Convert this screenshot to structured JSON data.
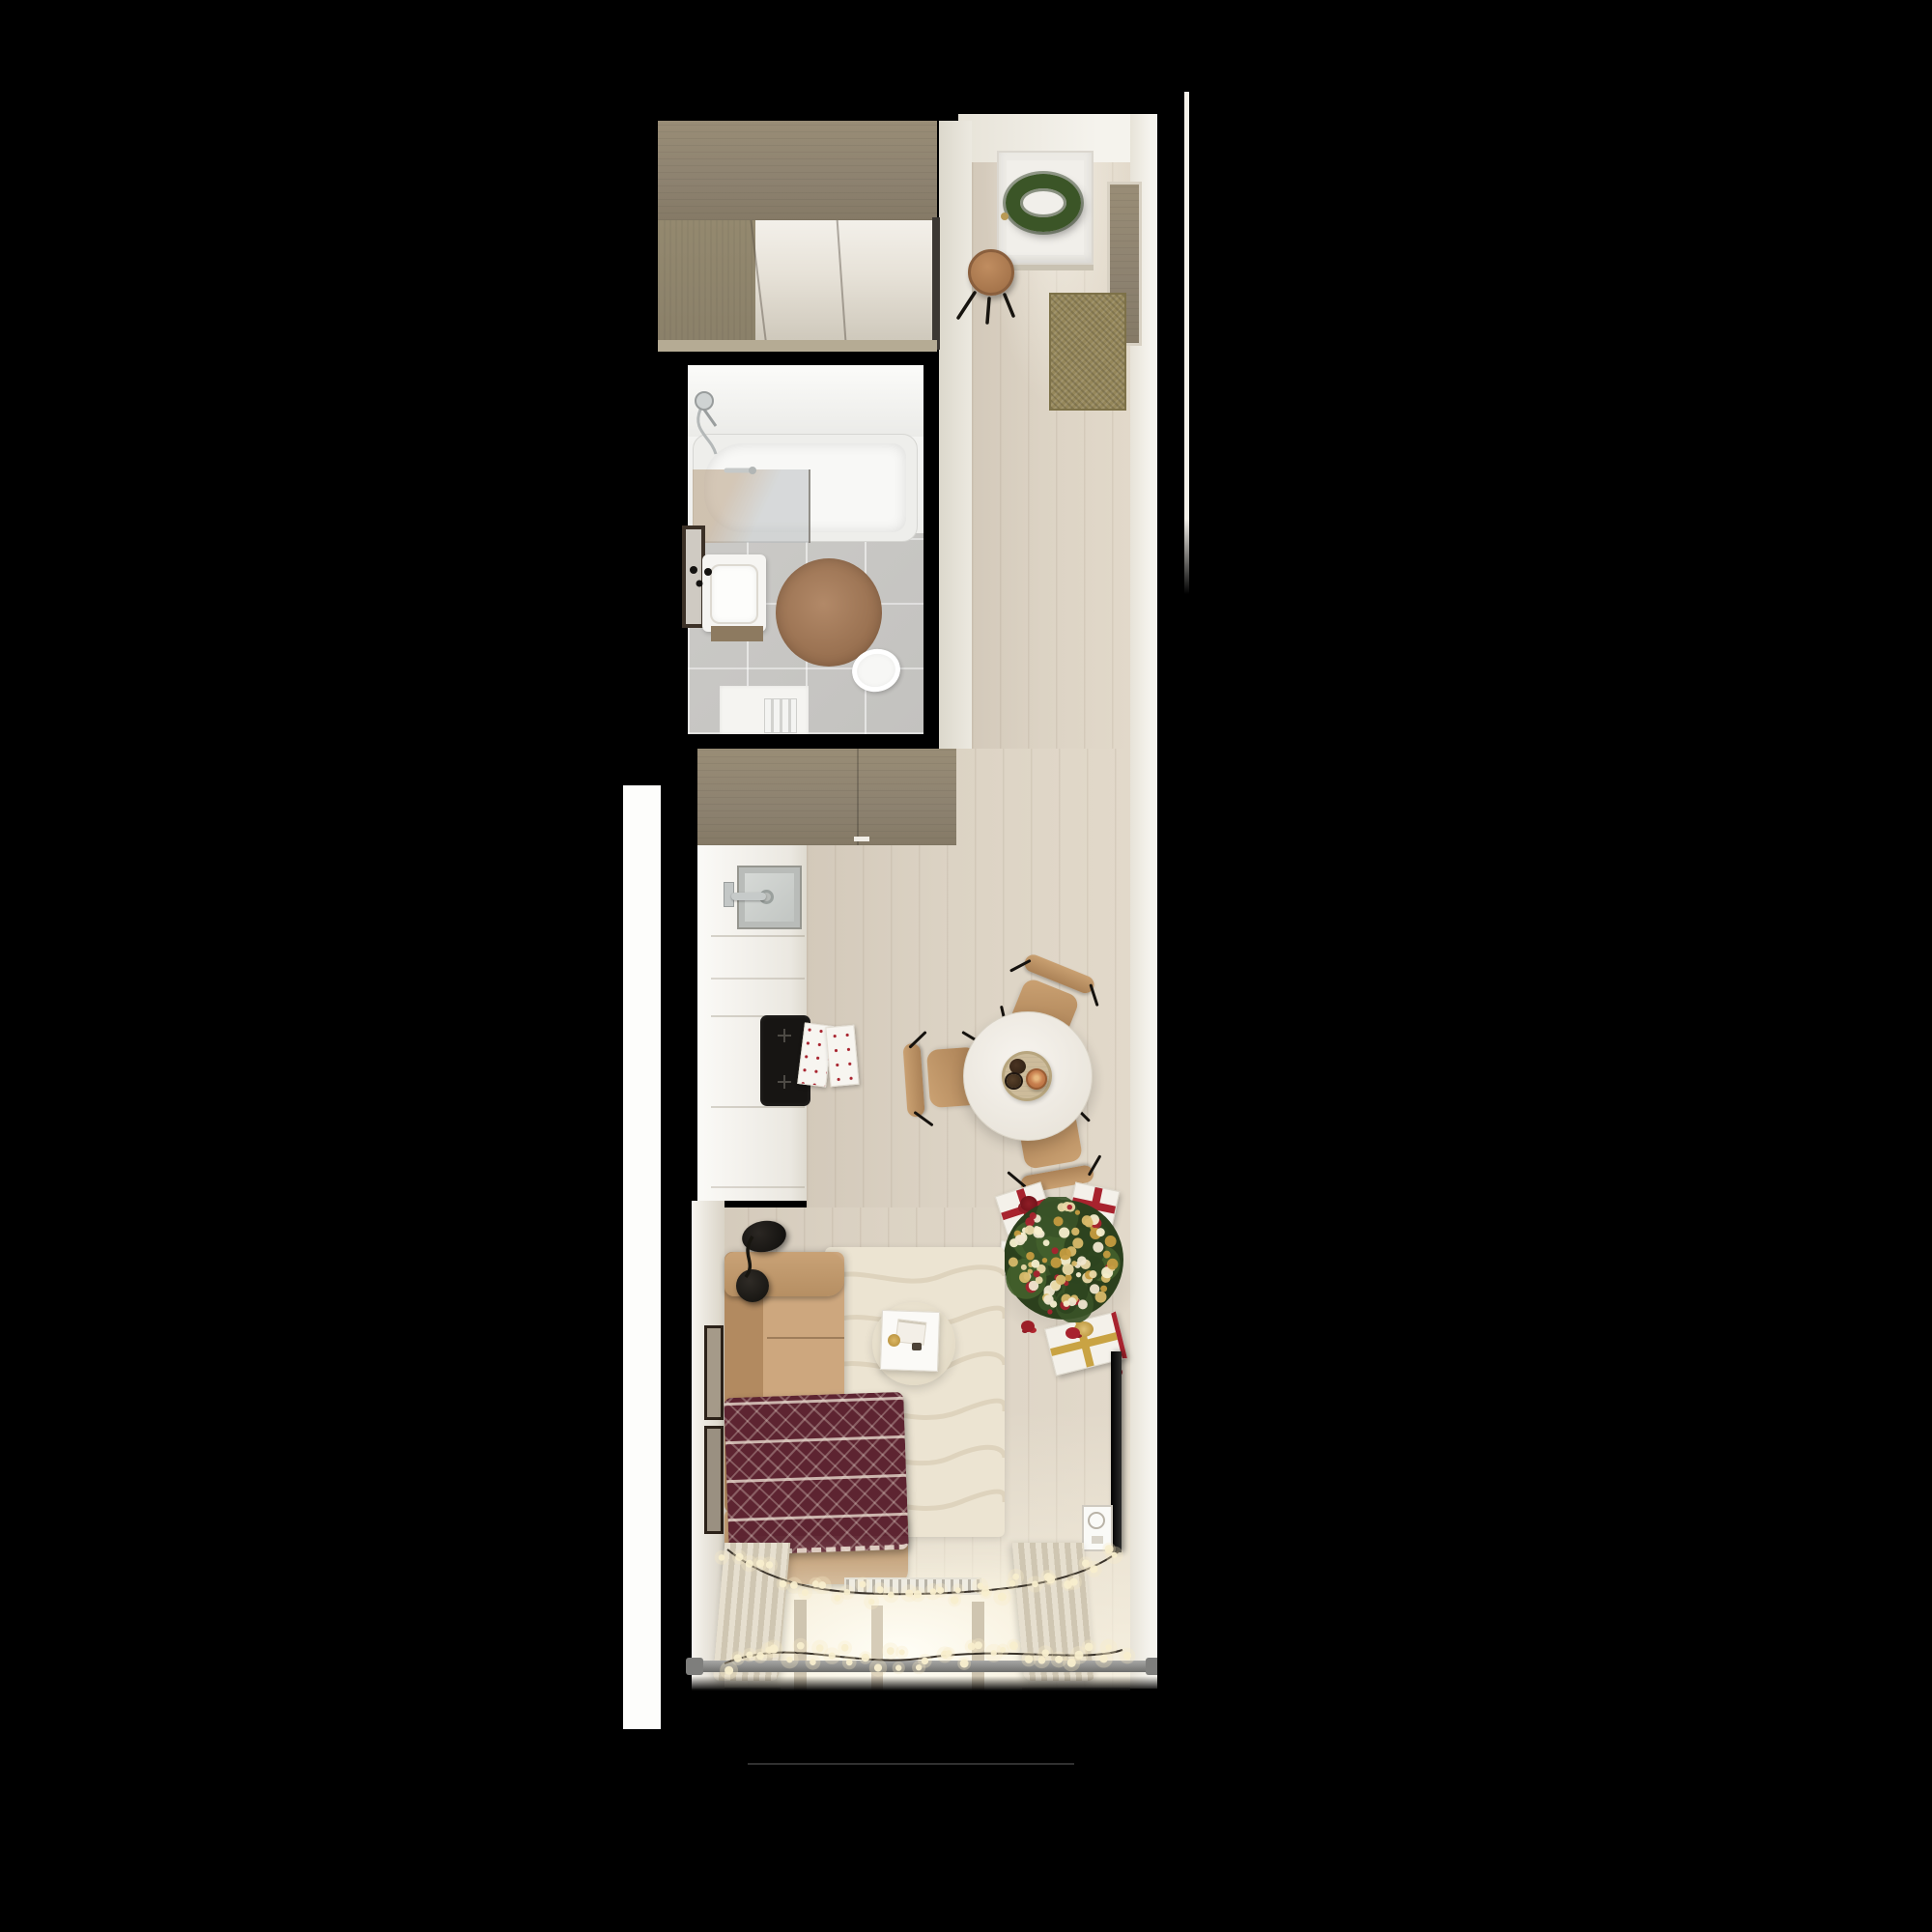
{
  "scene": {
    "type": "3d-floorplan-top-view-render",
    "description": "Top-down 3D render of a narrow studio apartment decorated for Christmas, on a black background",
    "background": "#000000"
  },
  "palette": {
    "bg": "#000000",
    "wood": "#92876f",
    "floor": "#d9d0c1",
    "wall": "#f2efe8",
    "bathWall": "#efefec",
    "bathFloor": "#c7c6c3",
    "tub": "#f6f6f3",
    "steel": "#b7bbba",
    "rugBrown": "#a57c5b",
    "matOlive": "#95875a",
    "stoolTan": "#b08255",
    "counter": "#f3f1ec",
    "sinkGray": "#ccd0ce",
    "cooktop": "#171513",
    "towelWhite": "#f7f5f0",
    "tableWhite": "#f2efe9",
    "tray": "#cdbc9b",
    "chairTan": "#c39a6a",
    "treeGreen": "#3a5328",
    "treeDark": "#2c401d",
    "gold": "#c9a343",
    "red": "#a8232e",
    "giftWhite": "#f4f1ea",
    "sofaTan": "#c7a178",
    "blanket": "#5d2431",
    "rugCream": "#ece4d2",
    "rugLine": "#dcd1ba",
    "curtain": "#ded6c4",
    "windowGlow": "#fdf8ec",
    "rod": "#8b8b89",
    "tvBlack": "#111110",
    "glow": "#f8ecc6",
    "wire": "#3a332a",
    "frameDark": "#2b2118",
    "wreathGreen": "#3b5527"
  },
  "rooms": [
    {
      "id": "entry-hall",
      "label": "Entrance hall",
      "objects": [
        "front-door",
        "christmas-wreath",
        "door-handle",
        "round-stool",
        "doormat",
        "wardrobe",
        "wall-niche-panel"
      ]
    },
    {
      "id": "bathroom",
      "label": "Bathroom",
      "objects": [
        "bathtub",
        "shower-set",
        "glass-screen",
        "mirror",
        "washbasin",
        "round-rug",
        "toilet",
        "towel-radiator",
        "door-slab"
      ]
    },
    {
      "id": "kitchen",
      "label": "Kitchen",
      "objects": [
        "upper-cabinets",
        "counter",
        "kitchen-sink",
        "faucet",
        "induction-cooktop",
        "tea-towels"
      ]
    },
    {
      "id": "dining",
      "label": "Dining area",
      "objects": [
        "round-table",
        "serving-tray",
        "cookies",
        "cinnamon-bun",
        "dining-chair",
        "dining-chair",
        "dining-chair"
      ]
    },
    {
      "id": "living",
      "label": "Living area",
      "objects": [
        "sofa",
        "christmas-blanket",
        "arc-floor-lamp",
        "cream-rug",
        "coffee-table",
        "side-table",
        "wall-frames",
        "tv",
        "christmas-tree",
        "gift-boxes",
        "wall-panel-socket"
      ]
    },
    {
      "id": "window-bay",
      "label": "Window bay",
      "objects": [
        "curtains",
        "window",
        "radiator",
        "curtain-rod",
        "string-lights"
      ]
    }
  ],
  "decor": {
    "string_lights": {
      "strands": 2,
      "bulbs_per_strand": [
        36,
        38
      ],
      "bulb_color": "#f8eecd"
    },
    "tree": {
      "foliage_colors": [
        "#3a5328",
        "#2e441f",
        "#44602c"
      ],
      "foliage_blobs": 26,
      "ornament_colors": [
        "#d8b96a",
        "#efe6cf",
        "#c49b3f",
        "#a8232e",
        "#e9d9a8",
        "#f6eecd"
      ],
      "ornament_count": 92,
      "gift_count": 4
    },
    "counts": {
      "dining_chairs": 3,
      "wall_frames": 2,
      "lamp_shades": 2
    }
  }
}
